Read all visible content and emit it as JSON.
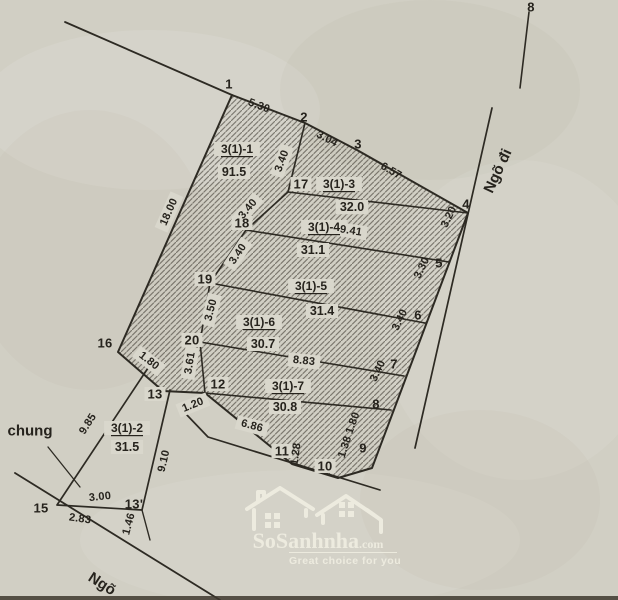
{
  "map": {
    "paper": "#d1cfc4",
    "paper_light": "#d9d7cc",
    "ink": "#2d2a23",
    "hatch_color": "rgba(52,48,40,0.55)",
    "lines": [
      {
        "name": "block-boundary",
        "closed": true,
        "hatch": true,
        "w": 2,
        "pts": [
          [
            232,
            95
          ],
          [
            305,
            123
          ],
          [
            357,
            150
          ],
          [
            468,
            213
          ],
          [
            372,
            468
          ],
          [
            338,
            478
          ],
          [
            292,
            464
          ],
          [
            205,
            393
          ],
          [
            163,
            391
          ],
          [
            118,
            352
          ]
        ]
      },
      {
        "name": "nw-approach",
        "closed": false,
        "w": 1.8,
        "pts": [
          [
            65,
            22
          ],
          [
            232,
            95
          ]
        ]
      },
      {
        "name": "divider-main",
        "closed": false,
        "w": 1.6,
        "pts": [
          [
            305,
            123
          ],
          [
            288,
            192
          ],
          [
            246,
            230
          ],
          [
            210,
            283
          ],
          [
            200,
            342
          ],
          [
            205,
            393
          ]
        ]
      },
      {
        "name": "divider-1",
        "closed": false,
        "w": 1.6,
        "pts": [
          [
            288,
            192
          ],
          [
            468,
            213
          ]
        ]
      },
      {
        "name": "divider-2",
        "closed": false,
        "w": 1.6,
        "pts": [
          [
            246,
            230
          ],
          [
            449,
            262
          ]
        ]
      },
      {
        "name": "divider-3",
        "closed": false,
        "w": 1.6,
        "pts": [
          [
            210,
            283
          ],
          [
            425,
            323
          ]
        ]
      },
      {
        "name": "divider-4",
        "closed": false,
        "w": 1.6,
        "pts": [
          [
            200,
            342
          ],
          [
            404,
            376
          ]
        ]
      },
      {
        "name": "divider-5",
        "closed": false,
        "w": 1.6,
        "pts": [
          [
            205,
            393
          ],
          [
            391,
            410
          ]
        ]
      },
      {
        "name": "plot2-strip",
        "closed": false,
        "w": 1.7,
        "pts": [
          [
            148,
            368
          ],
          [
            57,
            505
          ],
          [
            142,
            510
          ],
          [
            170,
            390
          ]
        ]
      },
      {
        "name": "east-alley-edge",
        "closed": false,
        "w": 1.7,
        "pts": [
          [
            492,
            108
          ],
          [
            415,
            448
          ]
        ]
      },
      {
        "name": "south-alley-edge",
        "closed": false,
        "w": 1.7,
        "pts": [
          [
            185,
            413
          ],
          [
            208,
            437
          ],
          [
            380,
            490
          ]
        ]
      },
      {
        "name": "bottom-road",
        "closed": false,
        "w": 1.8,
        "pts": [
          [
            15,
            473
          ],
          [
            220,
            600
          ]
        ]
      },
      {
        "name": "top-right-mark",
        "closed": false,
        "w": 1.6,
        "pts": [
          [
            529,
            12
          ],
          [
            520,
            88
          ]
        ]
      },
      {
        "name": "chung-leader",
        "closed": false,
        "w": 1.3,
        "pts": [
          [
            48,
            447
          ],
          [
            80,
            487
          ]
        ]
      },
      {
        "name": "point13p-drop",
        "closed": false,
        "w": 1.4,
        "pts": [
          [
            142,
            510
          ],
          [
            150,
            540
          ]
        ]
      }
    ],
    "points": [
      {
        "t": "1",
        "x": 229,
        "y": 84,
        "b": 0
      },
      {
        "t": "2",
        "x": 304,
        "y": 117,
        "b": 0
      },
      {
        "t": "3",
        "x": 358,
        "y": 144,
        "b": 0
      },
      {
        "t": "4",
        "x": 466,
        "y": 204,
        "b": 0
      },
      {
        "t": "5",
        "x": 439,
        "y": 263,
        "b": 0
      },
      {
        "t": "6",
        "x": 418,
        "y": 315,
        "b": 0
      },
      {
        "t": "7",
        "x": 394,
        "y": 364,
        "b": 0
      },
      {
        "t": "8",
        "x": 376,
        "y": 404,
        "b": 0
      },
      {
        "t": "9",
        "x": 363,
        "y": 448,
        "b": 0
      },
      {
        "t": "10",
        "x": 325,
        "y": 466,
        "b": 1
      },
      {
        "t": "11",
        "x": 282,
        "y": 451,
        "b": 1
      },
      {
        "t": "12",
        "x": 218,
        "y": 384,
        "b": 1
      },
      {
        "t": "13",
        "x": 155,
        "y": 394,
        "b": 1
      },
      {
        "t": "13'",
        "x": 134,
        "y": 504,
        "b": 0
      },
      {
        "t": "15",
        "x": 41,
        "y": 508,
        "b": 0
      },
      {
        "t": "16",
        "x": 105,
        "y": 343,
        "b": 0
      },
      {
        "t": "17",
        "x": 301,
        "y": 184,
        "b": 1
      },
      {
        "t": "18",
        "x": 242,
        "y": 223,
        "b": 1
      },
      {
        "t": "19",
        "x": 205,
        "y": 279,
        "b": 1
      },
      {
        "t": "20",
        "x": 192,
        "y": 340,
        "b": 1
      },
      {
        "t": "8",
        "x": 531,
        "y": 7,
        "b": 0
      }
    ],
    "dims": [
      {
        "t": "5.30",
        "x": 259,
        "y": 106,
        "r": 21,
        "b": 0
      },
      {
        "t": "3.04",
        "x": 327,
        "y": 139,
        "r": 27,
        "b": 0
      },
      {
        "t": "6.57",
        "x": 391,
        "y": 171,
        "r": 30,
        "b": 0
      },
      {
        "t": "18.00",
        "x": 169,
        "y": 212,
        "r": -66,
        "b": 1
      },
      {
        "t": "3.40",
        "x": 282,
        "y": 161,
        "r": -70,
        "b": 1
      },
      {
        "t": "3.40",
        "x": 248,
        "y": 209,
        "r": -50,
        "b": 1
      },
      {
        "t": "3.40",
        "x": 238,
        "y": 254,
        "r": -56,
        "b": 1
      },
      {
        "t": "3.50",
        "x": 211,
        "y": 310,
        "r": -76,
        "b": 1
      },
      {
        "t": "3.61",
        "x": 190,
        "y": 363,
        "r": -81,
        "b": 1
      },
      {
        "t": "1.20",
        "x": 193,
        "y": 405,
        "r": -22,
        "b": 1
      },
      {
        "t": "1.80",
        "x": 149,
        "y": 361,
        "r": 38,
        "b": 1
      },
      {
        "t": "3.20",
        "x": 449,
        "y": 217,
        "r": -64,
        "b": 0
      },
      {
        "t": "3.30",
        "x": 422,
        "y": 268,
        "r": -64,
        "b": 0
      },
      {
        "t": "3.40",
        "x": 400,
        "y": 320,
        "r": -64,
        "b": 0
      },
      {
        "t": "3.40",
        "x": 378,
        "y": 371,
        "r": -64,
        "b": 0
      },
      {
        "t": "1.80",
        "x": 353,
        "y": 423,
        "r": -70,
        "b": 0
      },
      {
        "t": "1.38",
        "x": 345,
        "y": 447,
        "r": -72,
        "b": 0
      },
      {
        "t": "1.28",
        "x": 296,
        "y": 454,
        "r": -82,
        "b": 0
      },
      {
        "t": "9.41",
        "x": 351,
        "y": 231,
        "r": 9,
        "b": 1
      },
      {
        "t": "8.83",
        "x": 304,
        "y": 361,
        "r": 6,
        "b": 1
      },
      {
        "t": "6.86",
        "x": 252,
        "y": 426,
        "r": 15,
        "b": 1
      },
      {
        "t": "9.85",
        "x": 88,
        "y": 424,
        "r": -57,
        "b": 0
      },
      {
        "t": "9.10",
        "x": 164,
        "y": 461,
        "r": -77,
        "b": 0
      },
      {
        "t": "3.00",
        "x": 100,
        "y": 497,
        "r": -6,
        "b": 0
      },
      {
        "t": "2.83",
        "x": 80,
        "y": 519,
        "r": 8,
        "b": 0
      },
      {
        "t": "1.46",
        "x": 129,
        "y": 524,
        "r": -75,
        "b": 0
      }
    ],
    "plots": [
      {
        "code": "3(1)-1",
        "cx": 237,
        "cy": 149,
        "area": "91.5",
        "ax": 234,
        "ay": 172
      },
      {
        "code": "3(1)-2",
        "cx": 127,
        "cy": 428,
        "area": "31.5",
        "ax": 127,
        "ay": 447
      },
      {
        "code": "3(1)-3",
        "cx": 339,
        "cy": 184,
        "area": "32.0",
        "ax": 352,
        "ay": 207
      },
      {
        "code": "3(1)-4",
        "cx": 324,
        "cy": 227,
        "area": "31.1",
        "ax": 313,
        "ay": 250
      },
      {
        "code": "3(1)-5",
        "cx": 311,
        "cy": 286,
        "area": "31.4",
        "ax": 322,
        "ay": 311
      },
      {
        "code": "3(1)-6",
        "cx": 259,
        "cy": 322,
        "area": "30.7",
        "ax": 263,
        "ay": 344
      },
      {
        "code": "3(1)-7",
        "cx": 288,
        "cy": 386,
        "area": "30.8",
        "ax": 285,
        "ay": 407
      }
    ],
    "texts": [
      {
        "t": "chung",
        "x": 30,
        "y": 431,
        "r": 0
      },
      {
        "t": "Ngõ đi",
        "x": 498,
        "y": 171,
        "r": -65
      },
      {
        "t": "Ngõ",
        "x": 102,
        "y": 584,
        "r": 33
      }
    ]
  },
  "watermark": {
    "brand": "SoSanhnha",
    "tld": ".com",
    "tagline": "Great choice for you",
    "color": "#f1efe3"
  }
}
